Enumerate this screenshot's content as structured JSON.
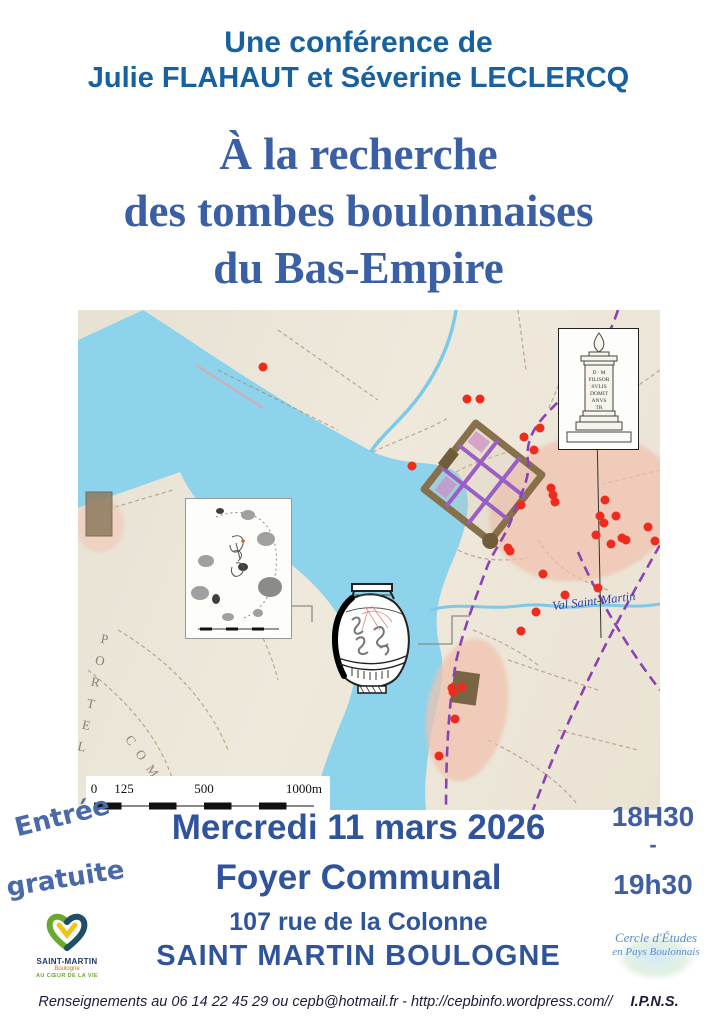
{
  "colors": {
    "header_blue": "#1761a0",
    "title_blue": "#3a5fa5",
    "event_blue": "#30549c",
    "water": "#8ed3ec",
    "dot": "#ee2b1c",
    "necropolis_pink": "#f1c0ad",
    "roman_road_purple": "#8a42b5",
    "city_wall_brown": "#87704a"
  },
  "header": {
    "line1": "Une conférence de",
    "line2": "Julie FLAHAUT et Séverine LECLERCQ"
  },
  "title": {
    "line1": "À la recherche",
    "line2": "des tombes boulonnaises",
    "line3": "du Bas-Empire"
  },
  "map": {
    "stream_label": "Val Saint-Martin",
    "coast_label": "PORTEL",
    "coast_label_2": "COM",
    "stele_inscription": [
      "D ∙ M",
      "FILISOR",
      "SVLIS",
      "DOMIT",
      "ANVS",
      "TR"
    ],
    "scale_labels": {
      "zero": "0",
      "l125": "125",
      "l500": "500",
      "l1000": "1000m"
    },
    "dots": [
      [
        185,
        57
      ],
      [
        389,
        89
      ],
      [
        402,
        89
      ],
      [
        334,
        156
      ],
      [
        446,
        127
      ],
      [
        456,
        140
      ],
      [
        462,
        118
      ],
      [
        430,
        238
      ],
      [
        473,
        178
      ],
      [
        475,
        185
      ],
      [
        477,
        192
      ],
      [
        443,
        195
      ],
      [
        527,
        190
      ],
      [
        522,
        206
      ],
      [
        538,
        206
      ],
      [
        526,
        213
      ],
      [
        544,
        228
      ],
      [
        518,
        225
      ],
      [
        533,
        234
      ],
      [
        548,
        230
      ],
      [
        432,
        241
      ],
      [
        570,
        217
      ],
      [
        577,
        231
      ],
      [
        465,
        264
      ],
      [
        487,
        285
      ],
      [
        520,
        278
      ],
      [
        458,
        302
      ],
      [
        443,
        321
      ],
      [
        374,
        378
      ],
      [
        384,
        377
      ],
      [
        375,
        382
      ],
      [
        377,
        409
      ],
      [
        361,
        446
      ]
    ]
  },
  "admission": {
    "line1": "Entrée",
    "line2": "gratuite"
  },
  "event": {
    "date": "Mercredi 11 mars 2026",
    "venue": "Foyer Communal",
    "address": "107 rue de la Colonne",
    "city": "SAINT MARTIN BOULOGNE"
  },
  "time": {
    "start": "18H30",
    "separator": "-",
    "end": "19h30"
  },
  "logos": {
    "saint_martin": {
      "name": "SAINT-MARTIN",
      "sub": "Boulogne",
      "tagline": "AU CŒUR DE LA VIE"
    },
    "cepb": {
      "line1": "Cercle d'Études",
      "line2": "en Pays Boulonnais"
    }
  },
  "footer": {
    "contact": "Renseignements au 06 14 22 45 29 ou cepb@hotmail.fr - http://cepbinfo.wordpress.com//",
    "ipns": "I.P.N.S."
  }
}
